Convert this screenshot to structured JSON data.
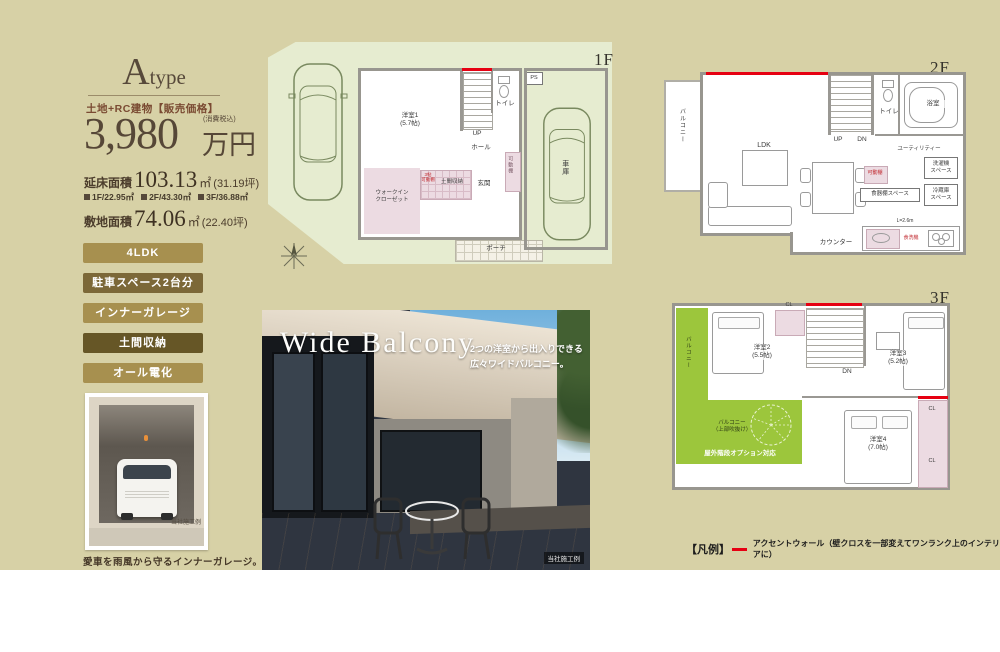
{
  "product": {
    "type_letter": "A",
    "type_word": "type",
    "price_category": "土地+RC建物【販売価格】",
    "price_value": "3,980",
    "price_unit": "万円",
    "price_note": "(消費税込)",
    "floor_area_label": "延床面積",
    "floor_area_value": "103.13",
    "floor_area_unit": "㎡",
    "floor_area_tsubo": "(31.19坪)",
    "floor_breakdown": [
      {
        "label": "1F/22.95㎡"
      },
      {
        "label": "2F/43.30㎡"
      },
      {
        "label": "3F/36.88㎡"
      }
    ],
    "land_area_label": "敷地面積",
    "land_area_value": "74.06",
    "land_area_unit": "㎡",
    "land_area_tsubo": "(22.40坪)"
  },
  "badges": [
    {
      "label": "4LDK"
    },
    {
      "label": "駐車スペース2台分"
    },
    {
      "label": "インナーガレージ"
    },
    {
      "label": "土間収納"
    },
    {
      "label": "オール電化"
    }
  ],
  "garage_photo": {
    "credit": "当社施工例",
    "caption": "愛車を雨風から守るインナーガレージ。"
  },
  "plan_1f": {
    "floor_label": "1F",
    "labels": {
      "room1": "洋室1\n(5.7帖)",
      "toilet": "トイレ",
      "up": "UP",
      "hall": "ホール",
      "entrance": "玄関",
      "porch": "ポーチ",
      "garage": "車庫",
      "wic": "ウォークイン\nクローゼット",
      "doma": "土間収納",
      "shelf": "3帖\n可動棚",
      "ps": "PS"
    }
  },
  "plan_2f": {
    "floor_label": "2F",
    "labels": {
      "balcony": "バルコニー",
      "ldk": "LDK\n(18.4帖)",
      "up": "UP",
      "dn": "DN",
      "toilet": "トイレ",
      "bath": "浴室",
      "utility": "ユーティリティー",
      "washer": "洗濯機\nスペース",
      "fridge": "冷蔵庫\nスペース",
      "cupboard": "食器棚スペース",
      "counter": "カウンター",
      "shelf": "可動棚",
      "kitchen_len": "L=2.6m",
      "dishwasher": "食洗機"
    }
  },
  "plan_3f": {
    "floor_label": "3F",
    "labels": {
      "balcony_side": "バルコニー",
      "room2": "洋室2\n(5.5帖)",
      "room3": "洋室3\n(5.2帖)",
      "room4": "洋室4\n(7.0帖)",
      "dn": "DN",
      "cl": "CL",
      "balcony_main": "バルコニー\n（上部吹抜け）",
      "option": "屋外階段オプション対応"
    }
  },
  "balcony_photo": {
    "title": "Wide Balcony",
    "desc": "2つの洋室から出入りできる\n広々ワイドバルコニー。",
    "credit": "当社施工例"
  },
  "legend": {
    "title": "【凡例】",
    "item": "アクセントウォール（壁クロスを一部変えてワンランク上のインテリアに）"
  },
  "colors": {
    "accent_red": "#e60012",
    "badge_gold": "#a7904f",
    "badge_dark": "#7c6838",
    "badge_darker": "#665626",
    "site_green": "#e6ecd0",
    "balcony_green": "#9cc63c"
  }
}
